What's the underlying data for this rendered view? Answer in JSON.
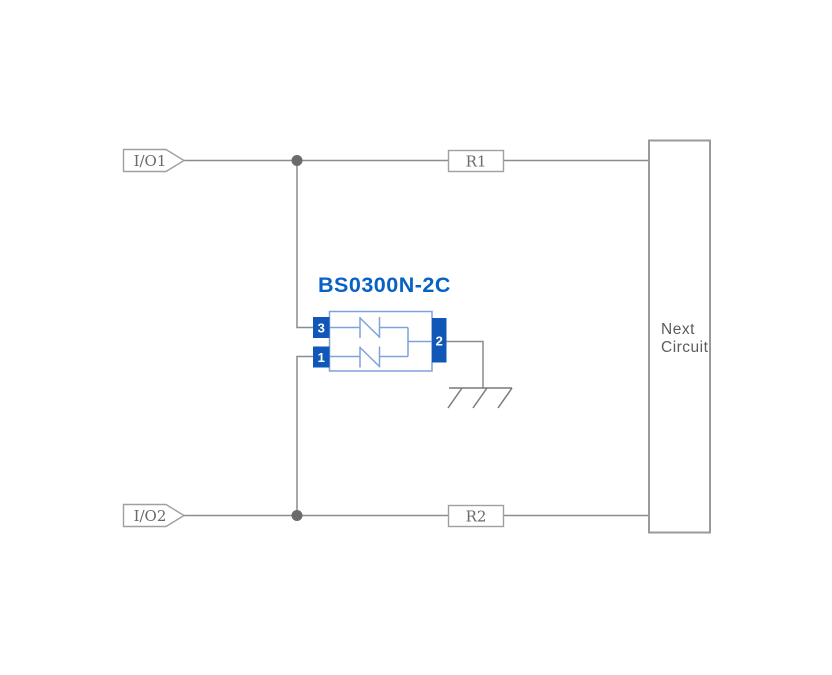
{
  "diagram": {
    "component": {
      "title": "BS0300N-2C",
      "pins": {
        "left_top": "3",
        "left_bottom": "1",
        "right": "2"
      }
    },
    "ports": {
      "io1": "I/O1",
      "io2": "I/O2"
    },
    "resistors": {
      "r1": "R1",
      "r2": "R2"
    },
    "next_circuit": {
      "line1": "Next",
      "line2": "Circuit"
    }
  },
  "colors": {
    "background": "#ffffff",
    "wire_gray": "#8c8c8c",
    "box_border_gray": "#a0a0a0",
    "label_gray": "#6a6a6a",
    "junction_dot_gray": "#6b6b6b",
    "component_pin_blue": "#1157b8",
    "component_outline_blue": "#7ea3db",
    "component_title_blue": "#0861c4"
  }
}
